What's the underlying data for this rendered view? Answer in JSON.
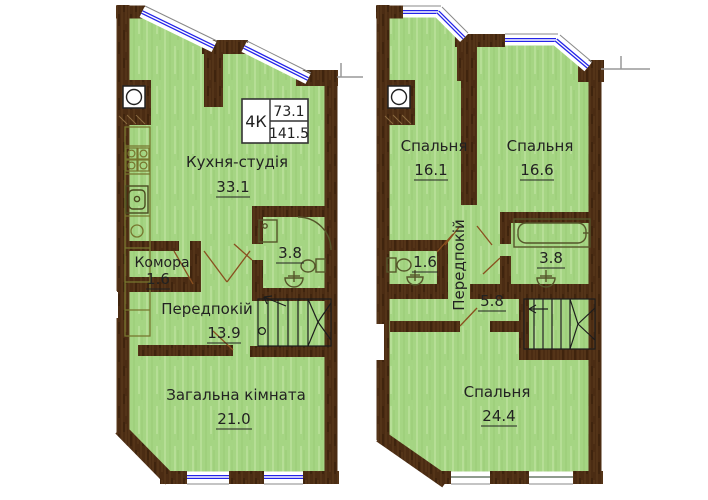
{
  "unit_label": {
    "type": "4К",
    "area_living": "73.1",
    "area_total": "141.5"
  },
  "level1": {
    "kitchen_studio": {
      "name": "Кухня-студія",
      "area": "33.1"
    },
    "pantry": {
      "name": "Комора",
      "area": "1.6"
    },
    "bathroom": {
      "area": "3.8"
    },
    "hallway": {
      "name": "Передпокій",
      "area": "13.9"
    },
    "living_room": {
      "name": "Загальна кімната",
      "area": "21.0"
    }
  },
  "level2": {
    "bedroom_left": {
      "name": "Спальня",
      "area": "16.1"
    },
    "bedroom_right": {
      "name": "Спальня",
      "area": "16.6"
    },
    "wc": {
      "area": "1.6"
    },
    "bathroom": {
      "area": "3.8"
    },
    "hallway": {
      "name": "Передпокій",
      "area": "5.8"
    },
    "bedroom_large": {
      "name": "Спальня",
      "area": "24.4"
    }
  },
  "colors": {
    "floor_green": "#a5d583",
    "wall_brown": "#4b2c13",
    "window_blue": "#2424e8"
  }
}
